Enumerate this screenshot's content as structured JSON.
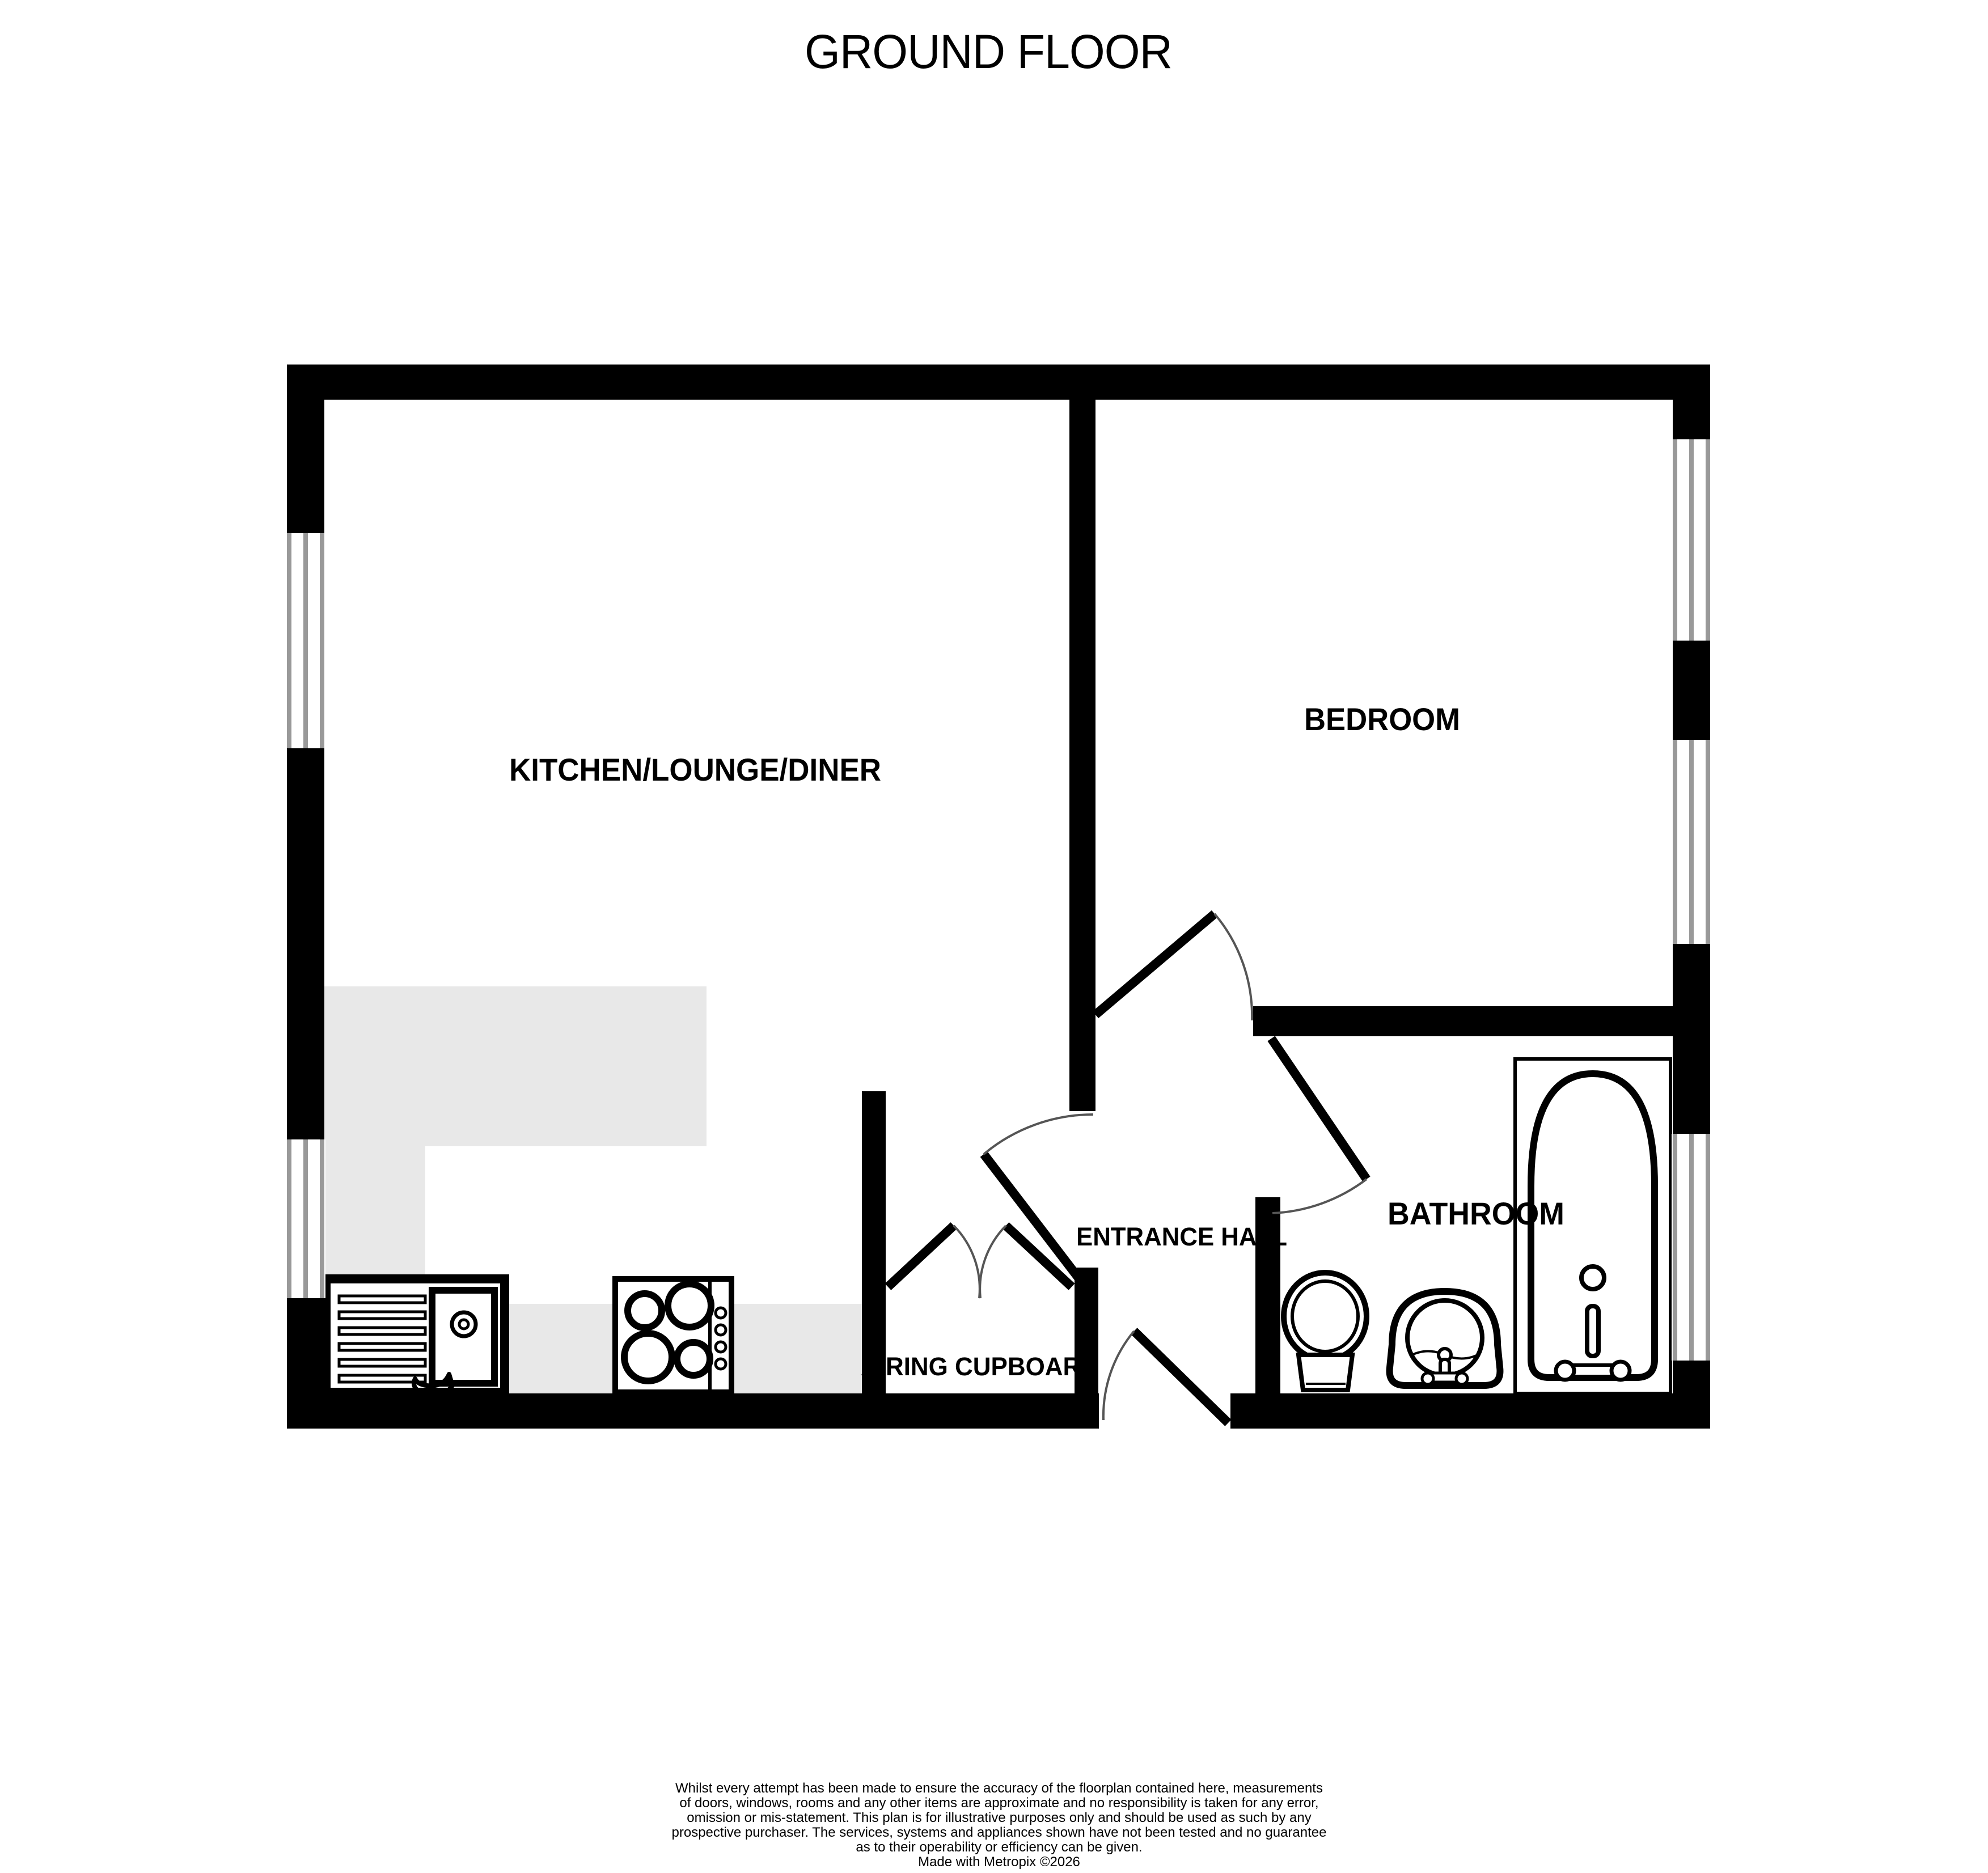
{
  "title": "GROUND FLOOR",
  "rooms": {
    "kitchen": "KITCHEN/LOUNGE/DINER",
    "bedroom": "BEDROOM",
    "entrance_hall": "ENTRANCE HALL",
    "bathroom": "BATHROOM",
    "airing_cupboard": "AIRING CUPBOARD"
  },
  "fixtures": {
    "kitchen_sink": "kitchen-sink-drainer",
    "hob": "four-ring-hob",
    "toilet": "toilet",
    "basin": "wash-basin",
    "bath": "bath-with-taps"
  },
  "colors": {
    "wall": "#000000",
    "counter": "#e8e8e8",
    "window_frame": "#999999",
    "door_arc": "#555555",
    "background": "#ffffff",
    "text": "#000000"
  },
  "disclaimer": {
    "lines": [
      "Whilst every attempt has been made to ensure the accuracy of the floorplan contained here, measurements",
      "of doors, windows, rooms and any other items are approximate and no responsibility is taken for any error,",
      "omission or mis-statement. This plan is for illustrative purposes only and should be used as such by any",
      "prospective purchaser. The services, systems and appliances shown have not been tested and no guarantee",
      "as to their operability or efficiency can be given.",
      "Made with Metropix ©2026"
    ]
  }
}
